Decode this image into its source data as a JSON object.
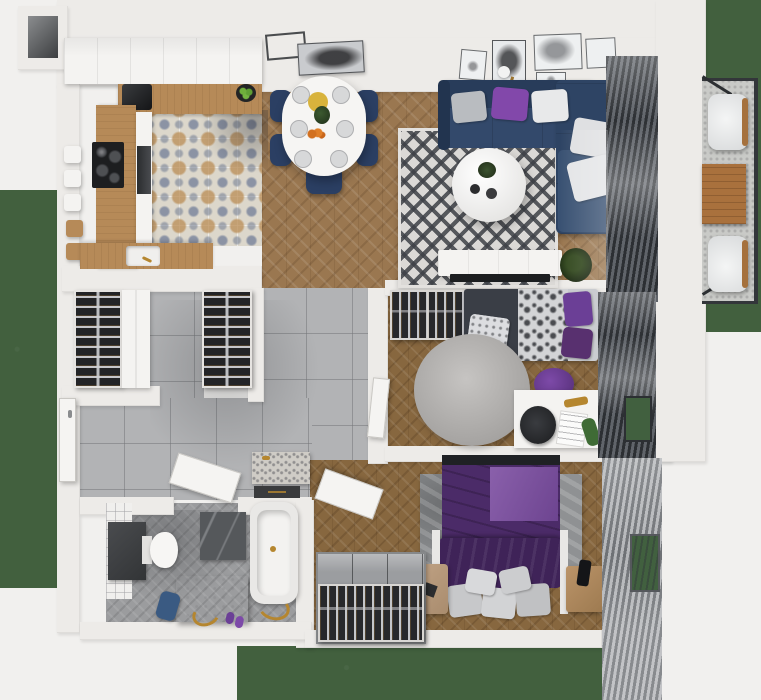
{
  "scene": {
    "title": "apartment-floor-plan-3d-top-view",
    "description": "photorealistic top-down 3D render of a furnished one-level apartment with surrounding grass"
  },
  "palette": {
    "background": "#f1f0ee",
    "wall": "#edebe8",
    "grass": "#42603e",
    "wood_floor": "#9a7750",
    "wood_floor_dark": "#87673f",
    "counter_wood": "#b68a58",
    "kitchen_tile": "#dcd7cb",
    "grey_tile": "#b2b3b5",
    "sofa_navy": "#2e4464",
    "chair_navy": "#2b3f63",
    "accent_purple": "#8248aa",
    "bed_purple_dark": "#4b2b68",
    "bed_purple_light": "#8a60ab",
    "rug_light": "#dbd9d6",
    "blinds_dark": "#2c2f33",
    "blinds_grey": "#6e7175",
    "gold": "#b5862f",
    "plant_green": "#3f6b35"
  },
  "rooms": {
    "kitchen": {
      "label": "Kitchen",
      "furniture": [
        "upper-cabinets",
        "wood-counter-top",
        "coffee-machine",
        "fruit-bowl",
        "cooktop",
        "oven",
        "sink",
        "bar-stools",
        "patterned-tile-floor"
      ]
    },
    "dining": {
      "label": "Dining area",
      "furniture": [
        "oval-white-table",
        "table-settings",
        "navy-dining-chairs",
        "wall-art-frames",
        "floor-lamp"
      ]
    },
    "living": {
      "label": "Living room",
      "furniture": [
        "navy-corner-sofa",
        "throw-pillows",
        "round-coffee-table",
        "diamond-rug",
        "tv-console",
        "tv",
        "plant",
        "gallery-frames",
        "window-blinds"
      ]
    },
    "closet": {
      "label": "Walk-in closet",
      "furniture": [
        "wardrobe-left",
        "wardrobe-right",
        "white-cabinet"
      ]
    },
    "hallway": {
      "label": "Hallway",
      "furniture": [
        "entrance-door",
        "stone-bench",
        "dark-doormat",
        "interior-doors"
      ]
    },
    "bathroom": {
      "label": "Bathroom",
      "furniture": [
        "toilet",
        "dark-counter",
        "marble-wall-panel",
        "vanity-unit",
        "bathtub",
        "gold-faucets",
        "blue-towel",
        "slippers"
      ]
    },
    "bedroom_small": {
      "label": "Small bedroom",
      "furniture": [
        "open-wardrobe",
        "single-bed",
        "round-rug",
        "purple-bean-bag",
        "desk",
        "desk-chair",
        "toy-dinosaur",
        "window-blinds"
      ]
    },
    "bedroom_master": {
      "label": "Master bedroom",
      "furniture": [
        "purple-double-bed",
        "grey-pillows",
        "textured-rug",
        "nightstand",
        "laundry-basket",
        "clothes-rack",
        "window-blinds"
      ]
    },
    "balcony": {
      "label": "Balcony",
      "furniture": [
        "armchair-top",
        "armchair-bottom",
        "wooden-table",
        "dark-railing"
      ]
    }
  }
}
